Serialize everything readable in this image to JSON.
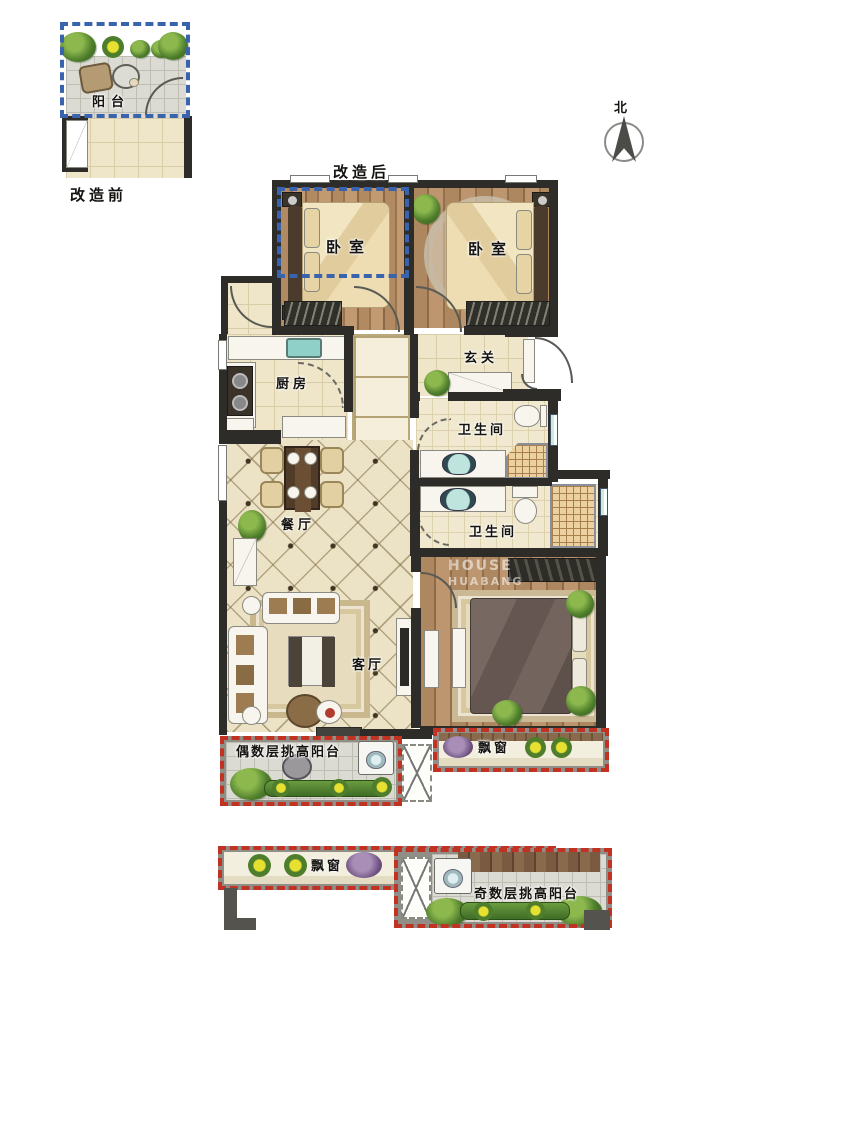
{
  "inset": {
    "room": "阳台",
    "caption": "改造前"
  },
  "plan": {
    "caption": "改造后"
  },
  "compass": {
    "north": "北"
  },
  "rooms": {
    "bedroom_left": "卧室",
    "bedroom_right": "卧室",
    "kitchen": "厨房",
    "foyer": "玄关",
    "bath_upper": "卫生间",
    "bath_lower": "卫生间",
    "dining": "餐厅",
    "living": "客厅",
    "balcony_even": "偶数层挑高阳台",
    "bay_window_main": "飘窗",
    "bay_window_lower": "飘窗",
    "balcony_odd": "奇数层挑高阳台"
  },
  "watermark": {
    "line1": "HOUSE",
    "line2": "HUABANG"
  },
  "colors": {
    "wall": "#2d2c28",
    "before_outline_blue": "#3a63ad",
    "after_outline_red": "#c13222",
    "wood_floor": "#a87f58",
    "beige_tile": "#efe6ca",
    "balcony_tile": "#dcdbd3"
  }
}
